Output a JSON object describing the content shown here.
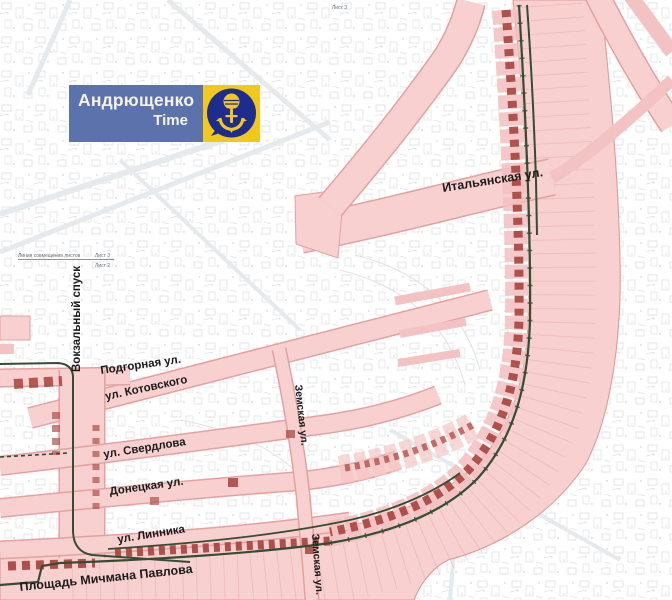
{
  "logo": {
    "title": "Андрющенко",
    "subtitle": "Time"
  },
  "sheet_notes": {
    "top_sheet": "Лист 3",
    "join_line_label": "Линия совмещения листов",
    "sheet_above": "Лист 3",
    "sheet_below": "Лист 2"
  },
  "streets": {
    "italyanskaya": "Итальянская ул.",
    "vokzalny": "Вокзальный спуск",
    "podgornaya": "Подгорная ул.",
    "kotovskogo": "ул. Котовского",
    "sverdlova": "ул. Свердлова",
    "donetskaya": "Донецкая ул.",
    "linnika": "ул. Линника",
    "ploshchad_pavlova": "Площадь Мичмана Павлова",
    "zemskaya_top": "Земская ул.",
    "zemskaya_bottom": "Земская ул."
  },
  "icons": {
    "logo_icon": "microphone-anchor-icon"
  },
  "colors": {
    "street_fill": "#f7d0cf",
    "street_edge": "#e09a99",
    "building_red": "#a8423c",
    "tram_green": "#344d33",
    "logo_blue": "#5b72ad",
    "logo_yellow": "#f2c71e",
    "logo_circle_blue": "#1c2d8e",
    "parcel_gray": "#dcdfe3"
  }
}
